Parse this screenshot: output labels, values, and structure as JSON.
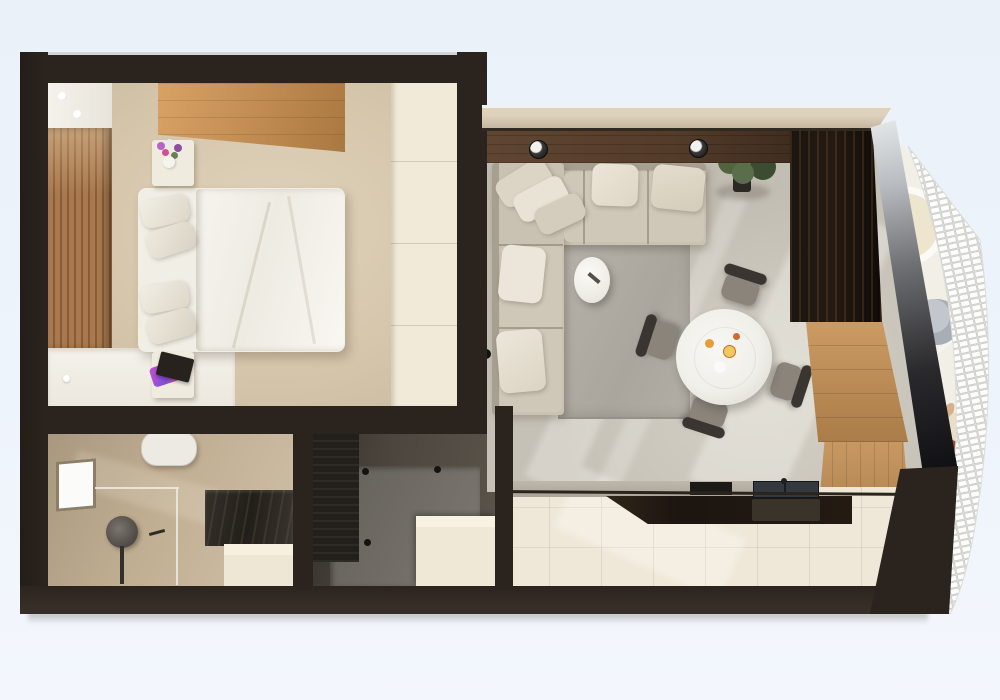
{
  "scene": {
    "label": "3D top-down architectural render of a one-bedroom apartment floor plan with bedroom, bathroom, utility room, open living-dining room, kitchen and a curved balcony with white brick lattice balustrade"
  },
  "palette": {
    "sky": "#ecf2f9",
    "wall": "#2b241e",
    "wall-cap": "#d3d6d8",
    "tan-wall": "#c2b29a",
    "bedroom-floor": "#d8cab1",
    "cream-tile": "#f1ead9",
    "wood-slat": "#a8794e",
    "wood-slat-dark": "#8a5c34",
    "wardrobe-wood": "#c9945c",
    "linen": "#f6f4ee",
    "pillow": "#e9e4d7",
    "nightstand": "#f0ebdf",
    "bath-floor": "#c2b096",
    "toilet": "#eceae2",
    "vanity-dark": "#2e2a25",
    "cream-cabinet": "#efe7d5",
    "utility-wall": "#4e4840",
    "utility-floor": "#716d66",
    "living-floor": "#c6c1b7",
    "rug": "#b0aca3",
    "sofa": "#c9c2b3",
    "cushion": "#e5dfd1",
    "walnut": "#5a4230",
    "media-dark": "#17130f",
    "sideboard-wood": "#c0905a",
    "kitchen-floor": "#efe8d9",
    "counter-top": "#b4aea3",
    "counter-dark": "#251e18",
    "sink": "#343940",
    "balcony-floor": "#f2efe7",
    "lattice": "#f7f7f5",
    "lattice-line": "#c9c9c4",
    "table-white": "#f3f2ee",
    "chair-dark": "#3a3531",
    "chair-seat": "#8a847b",
    "plant": "#4e6047",
    "book-black": "#27221e",
    "skin": "#d9b08c",
    "hair": "#9a4f33"
  },
  "rooms": {
    "bedroom": {
      "name": "bedroom",
      "furniture": [
        "double-bed",
        "duvet",
        "four-pillows",
        "nightstand-with-flower-vase",
        "nightstand-with-book-and-cloth",
        "light-oak-wardrobe",
        "wood-slat-headboard-wall",
        "ceiling-cove-with-two-spotlights",
        "white-vanity-desk",
        "cream-tile-border"
      ]
    },
    "bathroom": {
      "name": "bathroom",
      "furniture": [
        "toilet",
        "round-shower-head-on-column",
        "glass-shower-partition",
        "side-window",
        "dark-stone-vanity-counter",
        "cream-storage-cabinet",
        "faucet"
      ]
    },
    "utility_room": {
      "name": "utility-room",
      "furniture": [
        "dark-storage-cabinet",
        "grey-floor-tray",
        "three-wall-hooks",
        "cream-cabinet-block"
      ]
    },
    "living_room": {
      "name": "living-dining-room",
      "furniture": [
        "l-shaped-corner-sofa",
        "seven-throw-pillows",
        "grey-area-rug",
        "oval-white-coffee-table",
        "remote-control",
        "round-white-dining-table",
        "four-dark-dining-chairs",
        "plates-with-food",
        "potted-floor-plant",
        "walnut-accent-wall",
        "two-track-spotlights",
        "dark-marble-media-unit",
        "wood-sideboard"
      ]
    },
    "kitchen": {
      "name": "kitchen",
      "furniture": [
        "grey-countertop",
        "dark-sink-with-faucet",
        "black-cooktop",
        "under-counter-appliances",
        "tall-wood-pantry-cabinets",
        "cream-tile-floor"
      ]
    },
    "balcony": {
      "name": "balcony",
      "furniture": [
        "slanted-glass-wall",
        "curved-white-brick-lattice-balustrade",
        "white-arched-planter",
        "grey-cafe-table",
        "person-standing"
      ]
    }
  }
}
